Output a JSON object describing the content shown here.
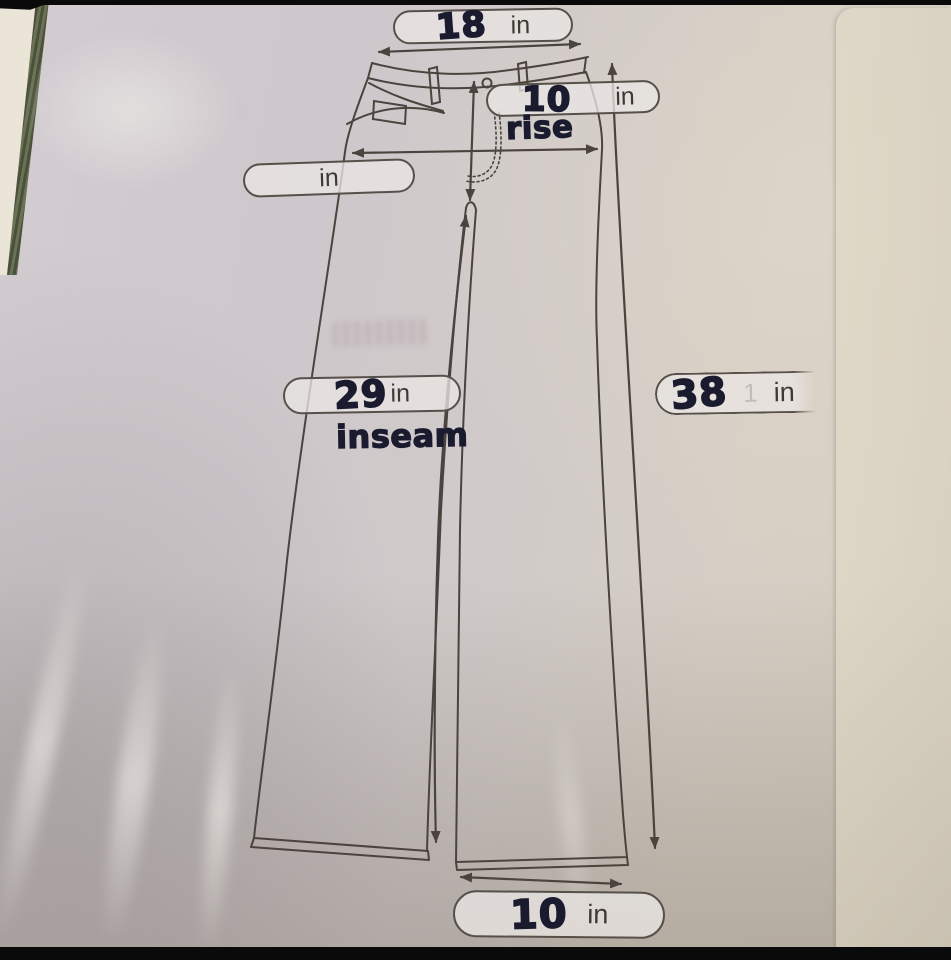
{
  "diagram": {
    "measurements": {
      "waist": {
        "value": "18",
        "unit": "in"
      },
      "rise": {
        "value": "10",
        "unit": "in",
        "label": "rise"
      },
      "hip": {
        "value": "",
        "unit": "in"
      },
      "inseam": {
        "value": "29",
        "unit": "in",
        "label": "inseam"
      },
      "length": {
        "value": "38",
        "ghost_digit": "1",
        "unit": "in"
      },
      "leg_opening": {
        "value": "10",
        "unit": "in"
      }
    }
  },
  "colors": {
    "paper": "#d0cacb",
    "paper_beige": "#d6cec1",
    "marker_ink": "#1b1b2f",
    "printed_ink": "#3d3a35",
    "drawing_line": "#4b433d",
    "binding_green": "#57604a",
    "binding_cream": "#eae5d6",
    "photo_bar": "#0a0a0a"
  }
}
